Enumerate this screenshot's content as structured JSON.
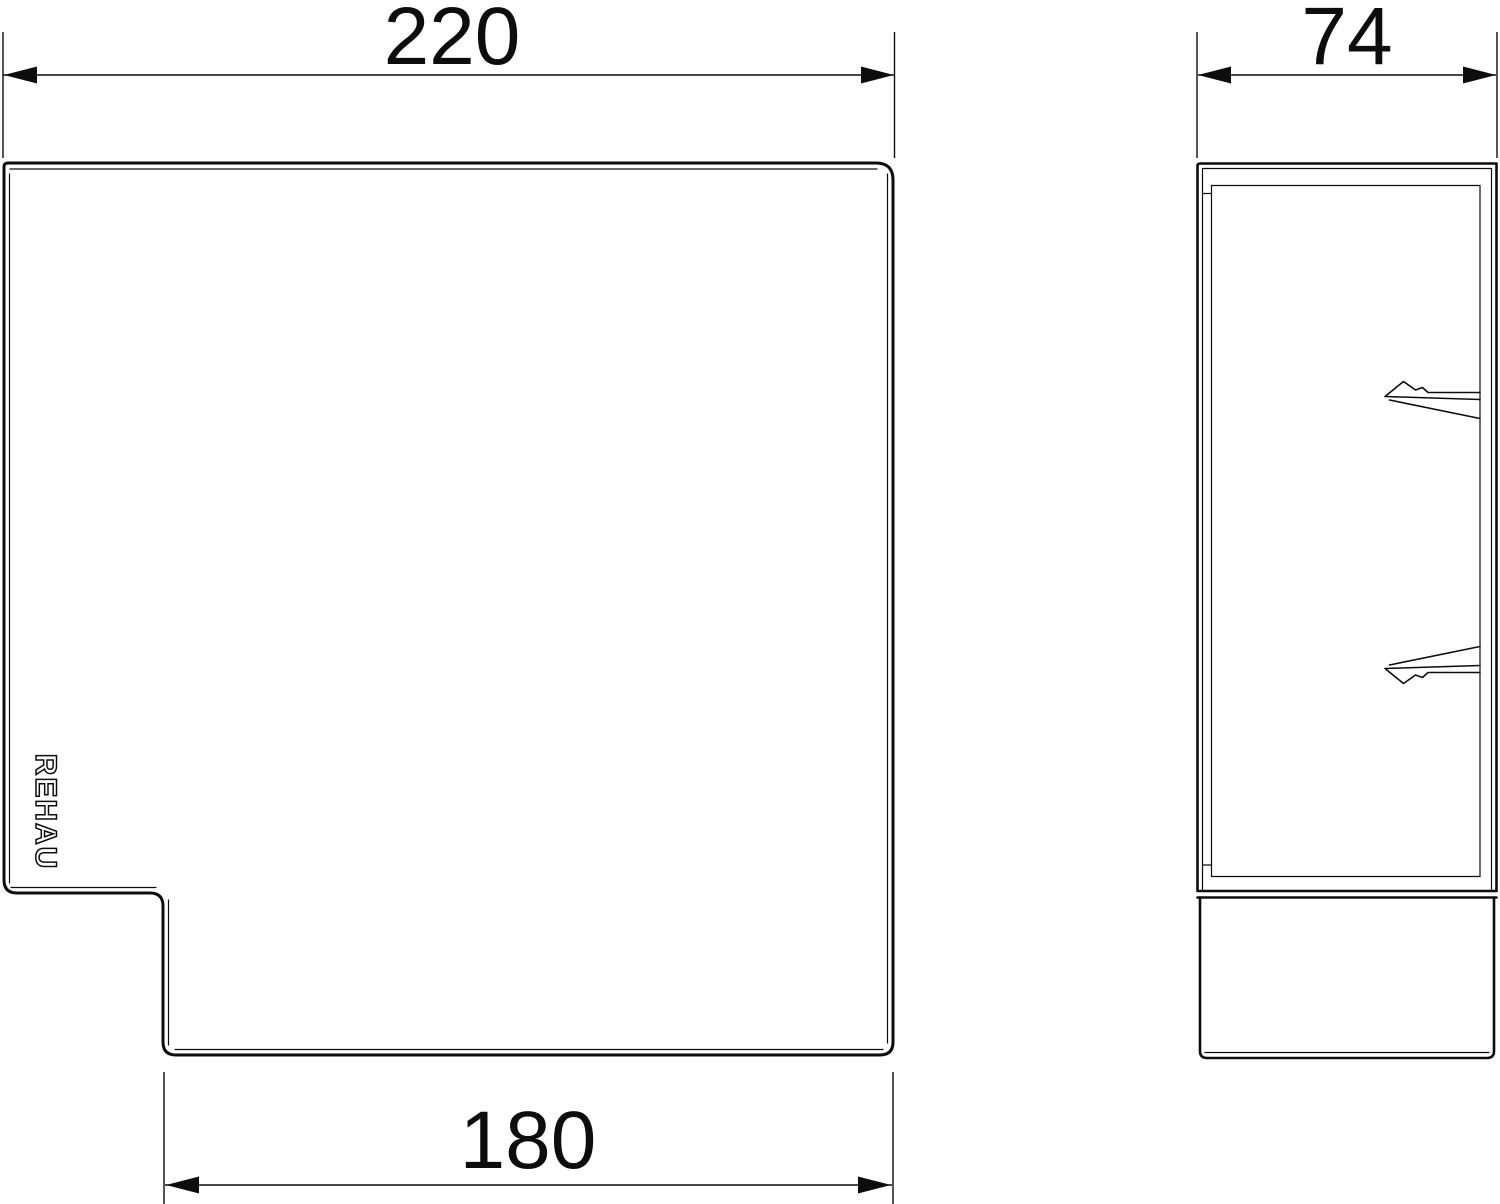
{
  "colors": {
    "background": "#ffffff",
    "line": "#0d0d0d"
  },
  "front_view": {
    "top_dimension": "220",
    "bottom_dimension": "180",
    "logo": "REHAU"
  },
  "side_view": {
    "top_dimension": "74"
  }
}
